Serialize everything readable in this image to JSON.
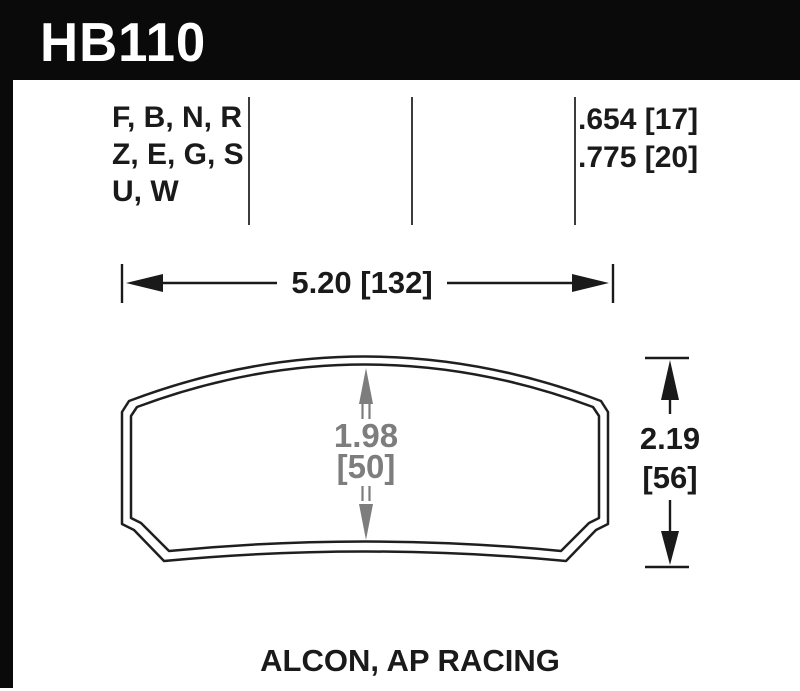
{
  "header": {
    "part_number": "HB110"
  },
  "compounds": {
    "lines": [
      "F, B, N, R",
      "Z, E, G, S",
      "U, W"
    ]
  },
  "thickness": {
    "lines": [
      ".654 [17]",
      ".775 [20]"
    ]
  },
  "dimensions": {
    "width": {
      "label": "5.20 [132]"
    },
    "height": {
      "line1": "2.19",
      "line2": "[56]"
    },
    "center": {
      "line1": "1.98",
      "line2": "[50]"
    }
  },
  "footer": {
    "application": "ALCON, AP RACING"
  },
  "colors": {
    "header_bg": "#0a0a0a",
    "header_text": "#ffffff",
    "ink": "#1a1a1a",
    "dim_gray": "#7d7d7d",
    "background": "#ffffff"
  }
}
